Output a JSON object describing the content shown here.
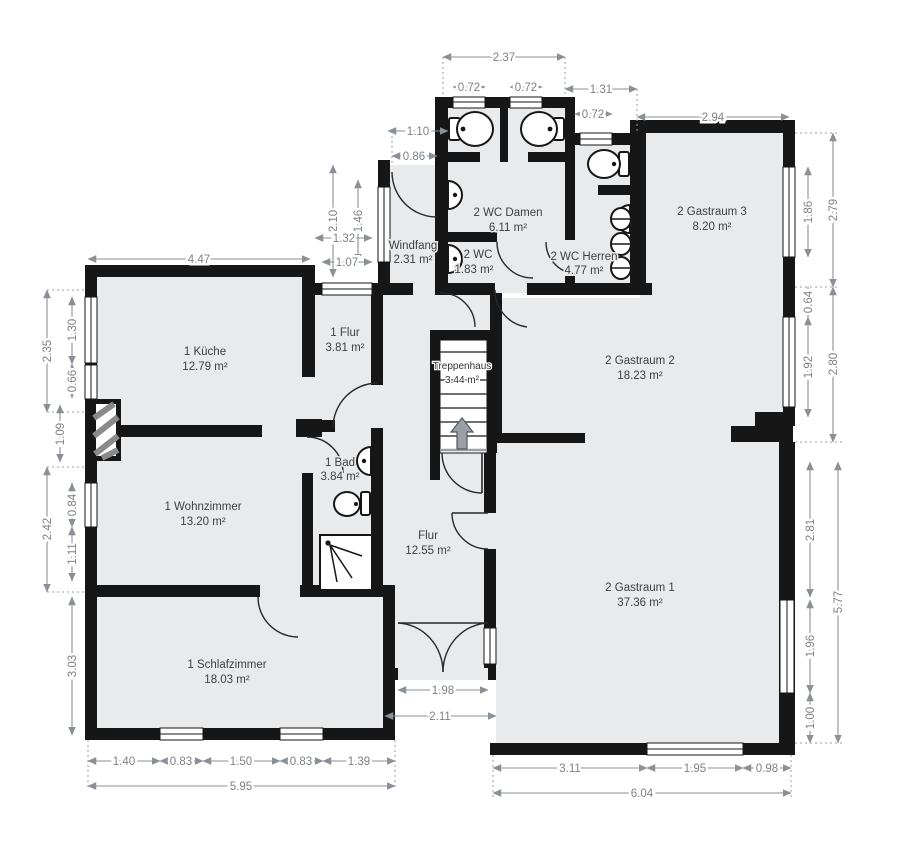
{
  "title": "Grundriss / floor plan",
  "colors": {
    "wall": "#161616",
    "room_fill": "#e9eaec",
    "dimension": "#7d8288",
    "label": "#3c4043"
  },
  "plan": {
    "rooms": [
      {
        "name": "1 Küche",
        "area": "12.79 m²"
      },
      {
        "name": "1 Flur",
        "area": "3.81 m²"
      },
      {
        "name": "1 Bad",
        "area": "3.84 m²"
      },
      {
        "name": "1 Wohnzimmer",
        "area": "13.20 m²"
      },
      {
        "name": "1 Schlafzimmer",
        "area": "18.03 m²"
      },
      {
        "name": "Windfang",
        "area": "2.31 m²"
      },
      {
        "name": "2 WC Damen",
        "area": "6.11 m²"
      },
      {
        "name": "2 WC",
        "area": "1.83 m²"
      },
      {
        "name": "2 WC Herren",
        "area": "4.77 m²"
      },
      {
        "name": "Treppenhaus",
        "area": "3.44 m²"
      },
      {
        "name": "Flur",
        "area": "12.55 m²"
      },
      {
        "name": "2 Gastraum 3",
        "area": "8.20 m²"
      },
      {
        "name": "2 Gastraum 2",
        "area": "18.23 m²"
      },
      {
        "name": "2 Gastraum 1",
        "area": "37.36 m²"
      }
    ],
    "dims": [
      "2.37",
      "0.72",
      "0.72",
      "1.31",
      "0.72",
      "2.94",
      "1.10",
      "0.86",
      "2.10",
      "1.46",
      "1.32",
      "1.07",
      "4.47",
      "2.35",
      "1.30",
      "0.66",
      "1.09",
      "2.42",
      "0.84",
      "1.11",
      "3.03",
      "1.40",
      "0.83",
      "1.50",
      "0.83",
      "1.39",
      "5.95",
      "1.98",
      "2.11",
      "3.11",
      "1.95",
      "0.98",
      "6.04",
      "1.86",
      "2.79",
      "0.64",
      "1.92",
      "2.80",
      "2.81",
      "5.77",
      "1.96",
      "1.00"
    ]
  }
}
